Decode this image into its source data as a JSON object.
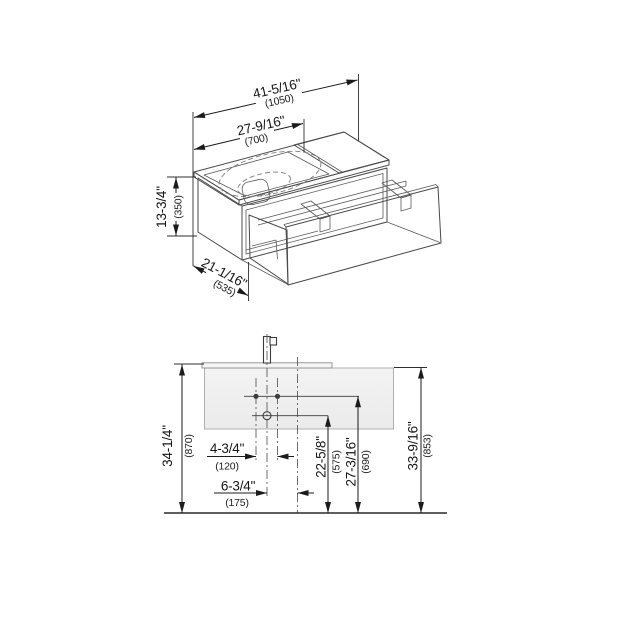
{
  "drawing": {
    "iso": {
      "dims": {
        "total_width": {
          "inches": "41-5/16\"",
          "mm": "(1050)"
        },
        "basin_width": {
          "inches": "27-9/16\"",
          "mm": "(700)"
        },
        "body_height": {
          "inches": "13-3/4\"",
          "mm": "(350)"
        },
        "depth": {
          "inches": "21-1/16\"",
          "mm": "(535)"
        }
      }
    },
    "front": {
      "dims": {
        "total_height": {
          "inches": "34-1/4\"",
          "mm": "(870)"
        },
        "tap_hole_spacing": {
          "inches": "4-3/4\"",
          "mm": "(120)"
        },
        "drain_offset": {
          "inches": "6-3/4\"",
          "mm": "(175)"
        },
        "drain_height": {
          "inches": "22-5/8\"",
          "mm": "(575)"
        },
        "tap_hole_height": {
          "inches": "27-3/16\"",
          "mm": "(690)"
        },
        "top_edge_height": {
          "inches": "33-9/16\"",
          "mm": "(853)"
        }
      }
    },
    "colors": {
      "background": "#ffffff",
      "dimension_line": "#1b1b1b",
      "object_outline": "#4a4a4a",
      "panel_fill": "#f1f1f1"
    }
  }
}
